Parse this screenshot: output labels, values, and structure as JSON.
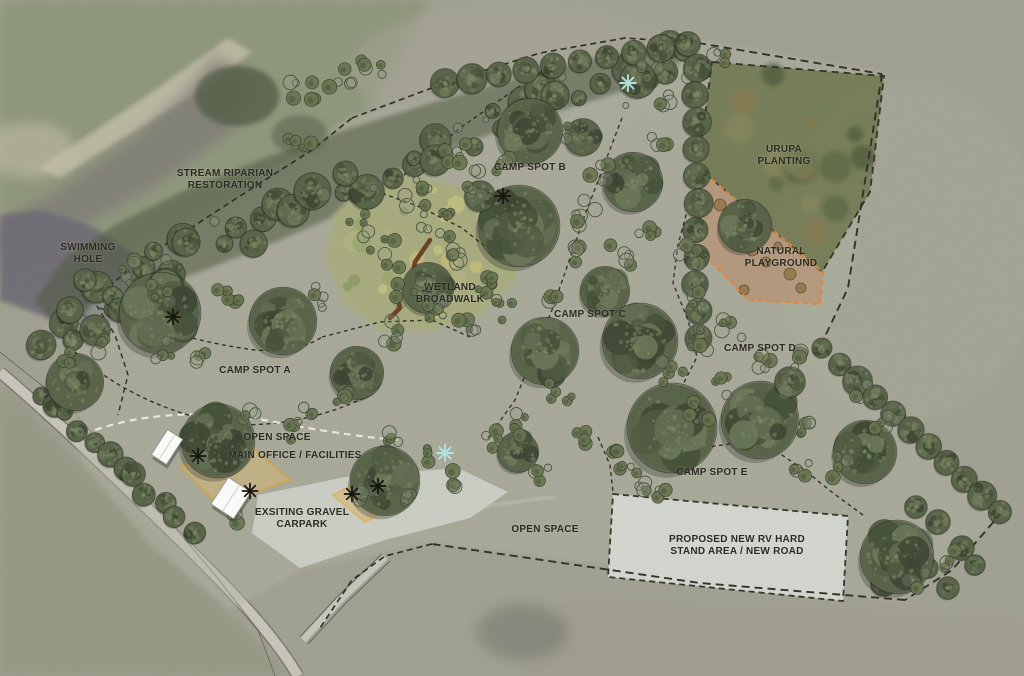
{
  "page": {
    "type": "campground-site-plan",
    "background": "aerial-photo-overlay"
  },
  "map": {
    "labels": [
      {
        "id": "stream-riparian-restoration",
        "text": "STREAM RIPARIAN\nRESTORATION",
        "x": 225,
        "y": 180
      },
      {
        "id": "swimming-hole",
        "text": "SWIMMING\nHOLE",
        "x": 88,
        "y": 254
      },
      {
        "id": "camp-spot-b",
        "text": "CAMP SPOT B",
        "x": 530,
        "y": 168
      },
      {
        "id": "urupa-planting",
        "text": "URUPA\nPLANTING",
        "x": 784,
        "y": 156
      },
      {
        "id": "wetland-broadwalk",
        "text": "WETLAND\nBROADWALK",
        "x": 450,
        "y": 294
      },
      {
        "id": "natural-playground",
        "text": "NATURAL\nPLAYGROUND",
        "x": 781,
        "y": 258
      },
      {
        "id": "camp-spot-c",
        "text": "CAMP SPOT C",
        "x": 590,
        "y": 315
      },
      {
        "id": "camp-spot-d",
        "text": "CAMP SPOT D",
        "x": 760,
        "y": 349
      },
      {
        "id": "camp-spot-a",
        "text": "CAMP SPOT A",
        "x": 255,
        "y": 371
      },
      {
        "id": "open-space-north",
        "text": "OPEN SPACE",
        "x": 277,
        "y": 438
      },
      {
        "id": "main-office-facilities",
        "text": "MAIN OFFICE / FACILITIES",
        "x": 295,
        "y": 456
      },
      {
        "id": "existing-gravel-carpark",
        "text": "EXSITING GRAVEL\nCARPARK",
        "x": 302,
        "y": 519
      },
      {
        "id": "camp-spot-e",
        "text": "CAMP SPOT E",
        "x": 712,
        "y": 473
      },
      {
        "id": "open-space-south",
        "text": "OPEN SPACE",
        "x": 545,
        "y": 530
      },
      {
        "id": "proposed-rv-hard-stand",
        "text": "PROPOSED NEW RV HARD\nSTAND AREA / NEW ROAD",
        "x": 737,
        "y": 546
      }
    ],
    "markers": {
      "feature_black": [
        [
          173,
          317
        ],
        [
          503,
          196
        ],
        [
          198,
          456
        ],
        [
          250,
          491
        ],
        [
          352,
          494
        ],
        [
          378,
          486
        ]
      ],
      "feature_cyan": [
        [
          628,
          83
        ],
        [
          445,
          453
        ]
      ]
    },
    "colors": {
      "label_text": "#2b2a23",
      "boundary_line": "#33332b",
      "path_white": "#f1efe4",
      "marker_black": "#16160f",
      "marker_cyan": "#b5e7e6",
      "wetland_fill": "#a9ae7c",
      "boardwalk_brown": "#6f4328",
      "playground_border": "#e2873b",
      "playground_fill": "#c08a64",
      "office_zone_border": "#e9a71e",
      "office_zone_fill": "#d7b878",
      "rv_pad_fill": "#d6dad2",
      "carpark_fill": "#cdd1c7",
      "road_fill": "#c9c7bb",
      "water_fill": "#716d76",
      "site_wash": "#b4b8a6",
      "aerial_base": "#a3a394",
      "aerial_green": "#8f987c",
      "tree_canopy": "#5a654a"
    }
  }
}
